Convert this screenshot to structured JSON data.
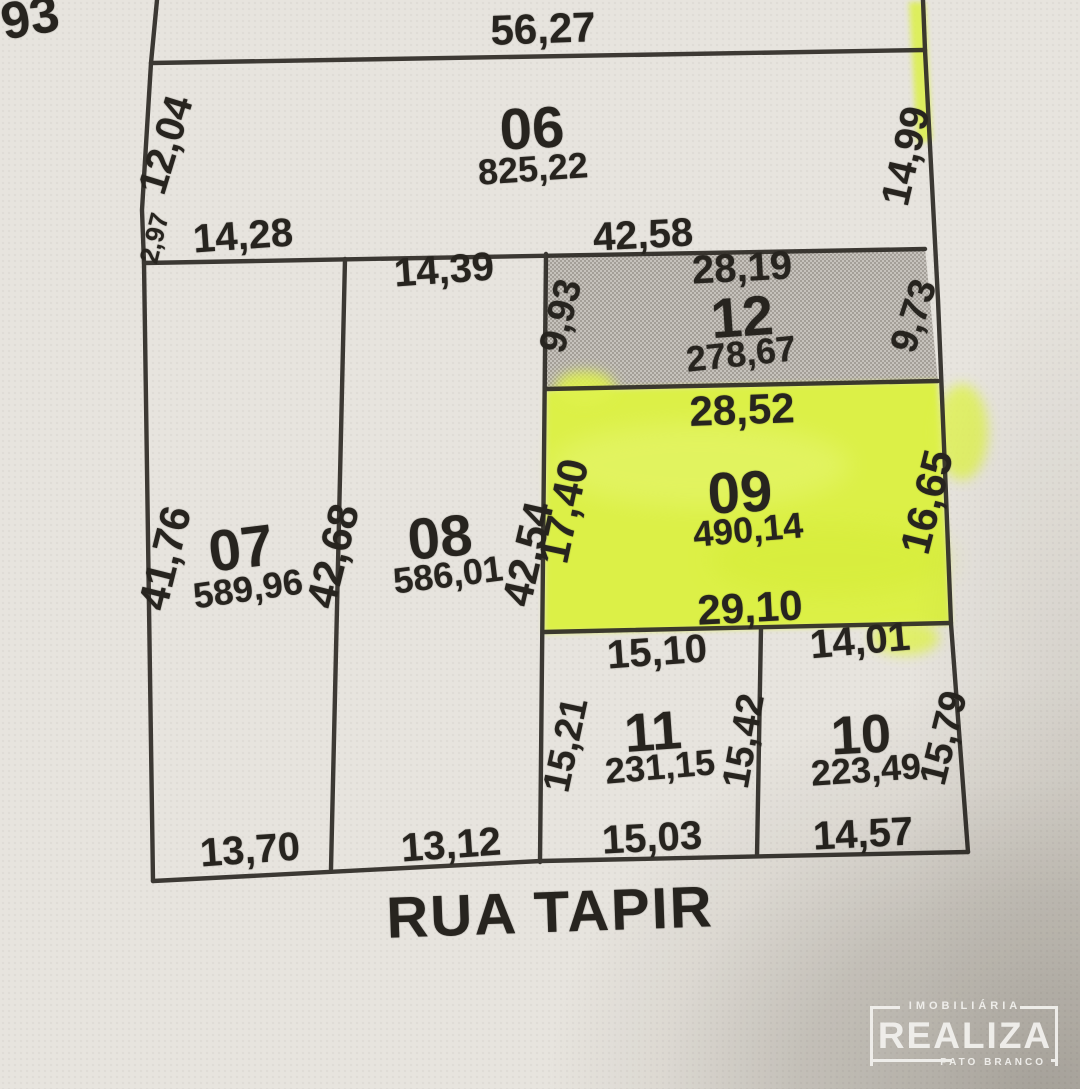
{
  "corner_text": "93",
  "street": {
    "name": "RUA TAPIR"
  },
  "lots": {
    "lot06": {
      "number": "06",
      "area": "825,22",
      "top": "56,27",
      "left_upper": "12,04",
      "left_lower": "2,97",
      "bottom_left": "14,28",
      "bottom_right": "42,58",
      "right": "14,99"
    },
    "lot07": {
      "number": "07",
      "area": "589,96",
      "left": "41,76",
      "right": "42,68",
      "bottom": "13,70"
    },
    "lot08": {
      "number": "08",
      "area": "586,01",
      "top": "14,39",
      "right": "42,54",
      "bottom": "13,12"
    },
    "lot09": {
      "number": "09",
      "area": "490,14",
      "top": "28,52",
      "left": "17,40",
      "right": "16,65",
      "bottom": "29,10"
    },
    "lot10": {
      "number": "10",
      "area": "223,49",
      "top": "14,01",
      "right": "15,79",
      "bottom": "14,57"
    },
    "lot11": {
      "number": "11",
      "area": "231,15",
      "top": "15,10",
      "left": "15,21",
      "right": "15,42",
      "bottom": "15,03"
    },
    "lot12": {
      "number": "12",
      "area": "278,67",
      "top": "28,19",
      "left": "9,93",
      "right": "9,73"
    }
  },
  "logo": {
    "sector": "IMOBILIÁRIA",
    "name": "REALIZA",
    "city": "PATO BRANCO"
  },
  "colors": {
    "paper": "#e7e4de",
    "ink_line": "#2f2c27",
    "text_ink": "#27241f",
    "lot09_highlight": "#dcf046",
    "lot12_halftone_light": "#c6c2bc",
    "lot12_halftone_dark": "#a49f98",
    "corner_shadow": "#c5c2bd",
    "logo_white": "#f3f2ef"
  }
}
